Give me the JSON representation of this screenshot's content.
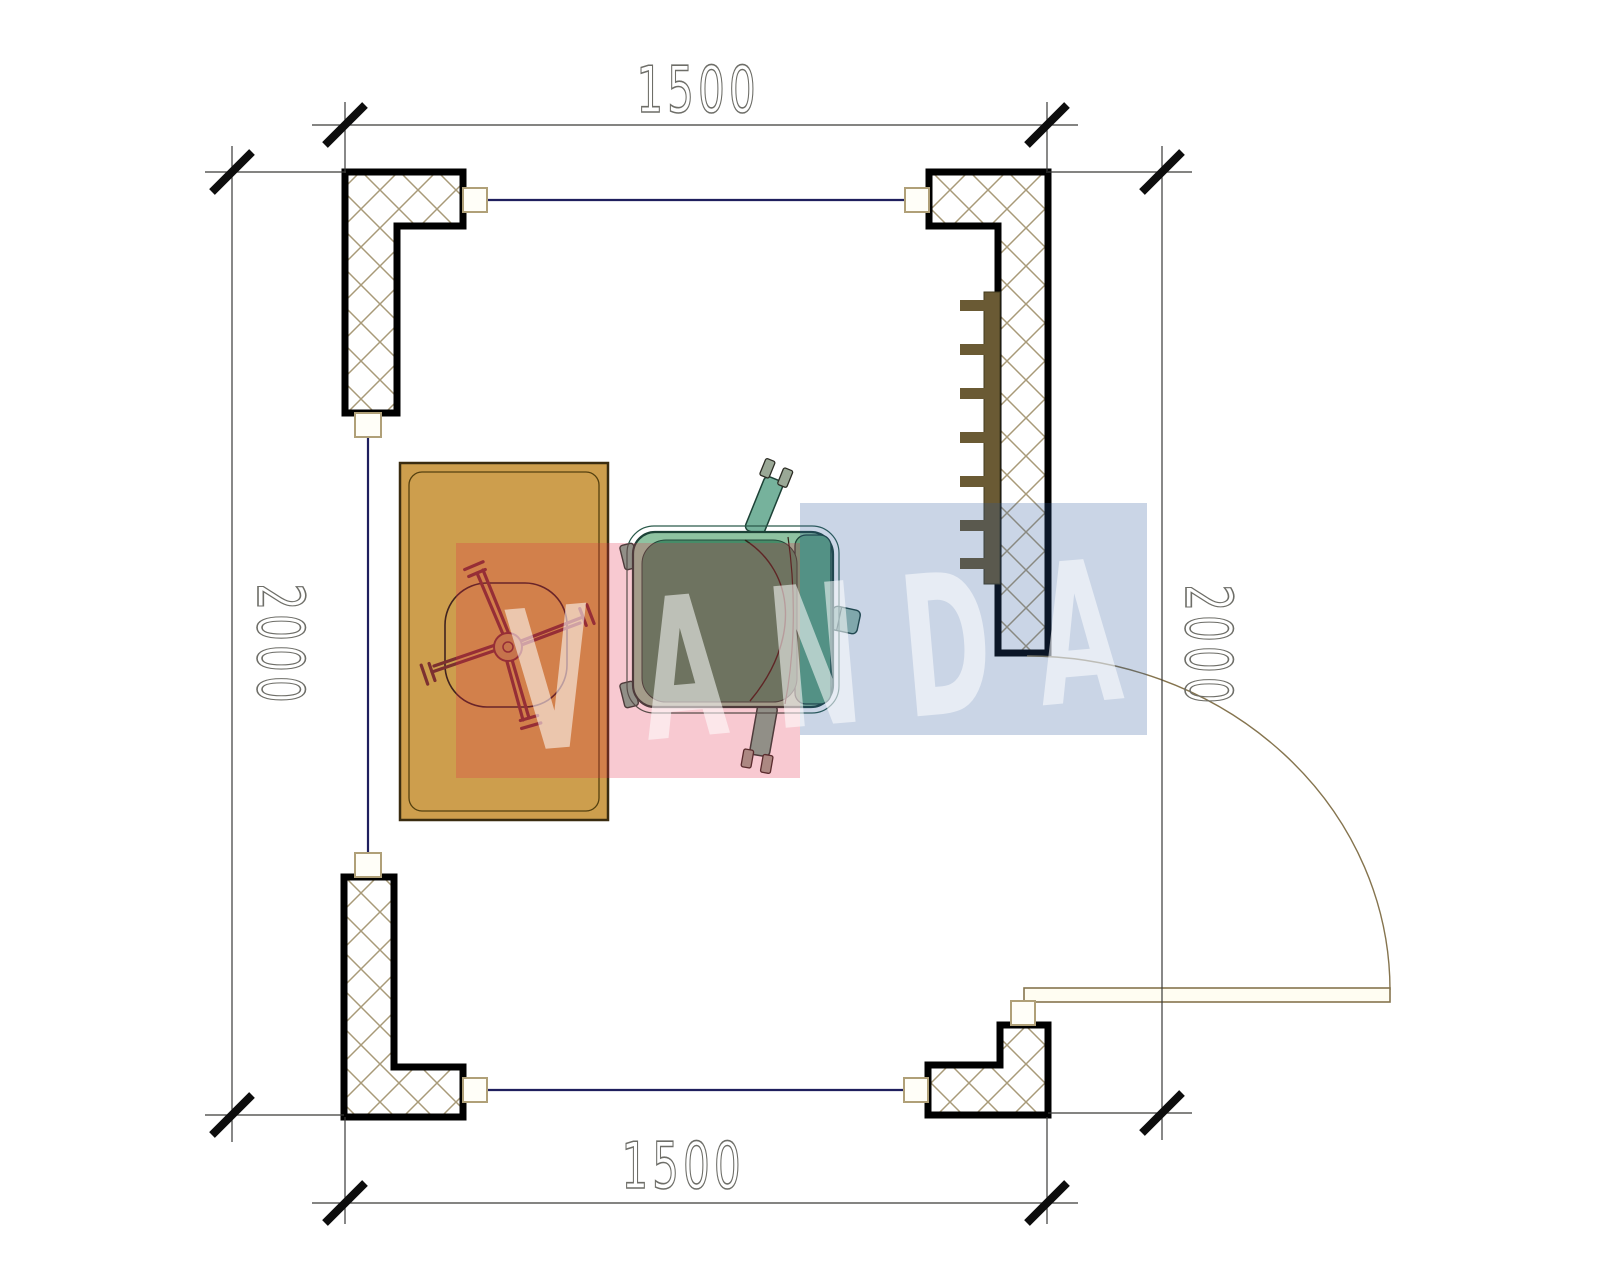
{
  "plan": {
    "dimensions": {
      "top": {
        "label": "1500"
      },
      "bottom": {
        "label": "1500"
      },
      "left": {
        "label": "2000"
      },
      "right": {
        "label": "2000"
      }
    },
    "watermark": {
      "text": "VANDA",
      "letters": [
        "V",
        "A",
        "N",
        "D",
        "A"
      ],
      "tile_colors": [
        "rgba(228,40,72,0.25)",
        "rgba(43,87,155,0.25)"
      ],
      "text_color": "rgba(255,255,255,0.55)"
    },
    "colors": {
      "wall_outline": "#000000",
      "hatch_line": "#a89a78",
      "window_line": "#1f1f5e",
      "desk_fill": "#cd9e4d",
      "desk_chair_line": "#7c3030",
      "armchair_body": "#8fc3a1",
      "armchair_seat": "#478c68",
      "armchair_back": "#61a47e",
      "radiator": "#6a5a34",
      "door_line": "#85744e",
      "dimension_text": "#6e6e68"
    }
  }
}
